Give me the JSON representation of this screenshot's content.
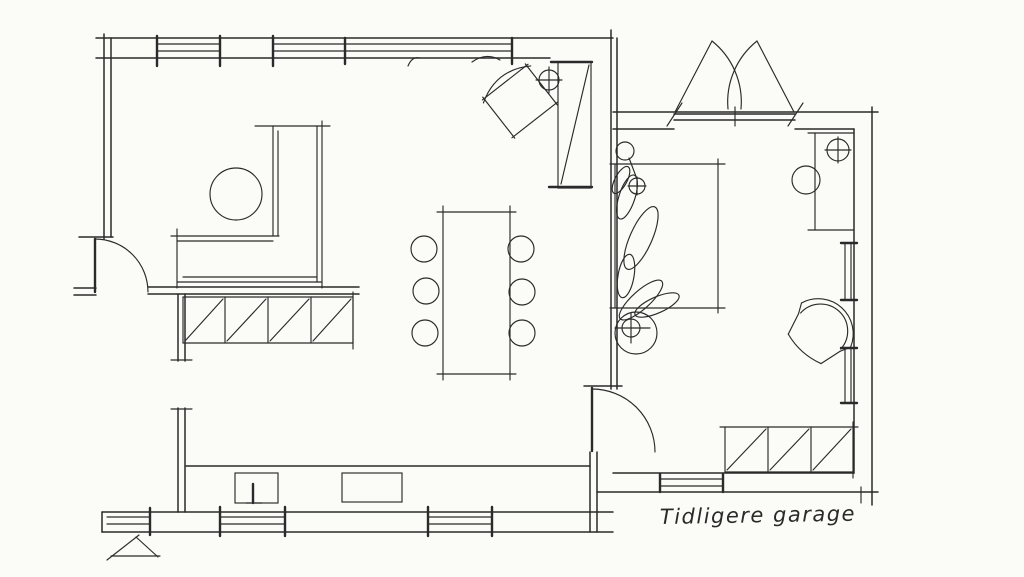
{
  "drawing": {
    "kind": "hand-drawn floor plan sketch"
  },
  "colors": {
    "paper": "#fbfbf7",
    "ink": "#2a2a2a"
  },
  "annotations": {
    "former_garage_label": "Tidligere garage"
  }
}
